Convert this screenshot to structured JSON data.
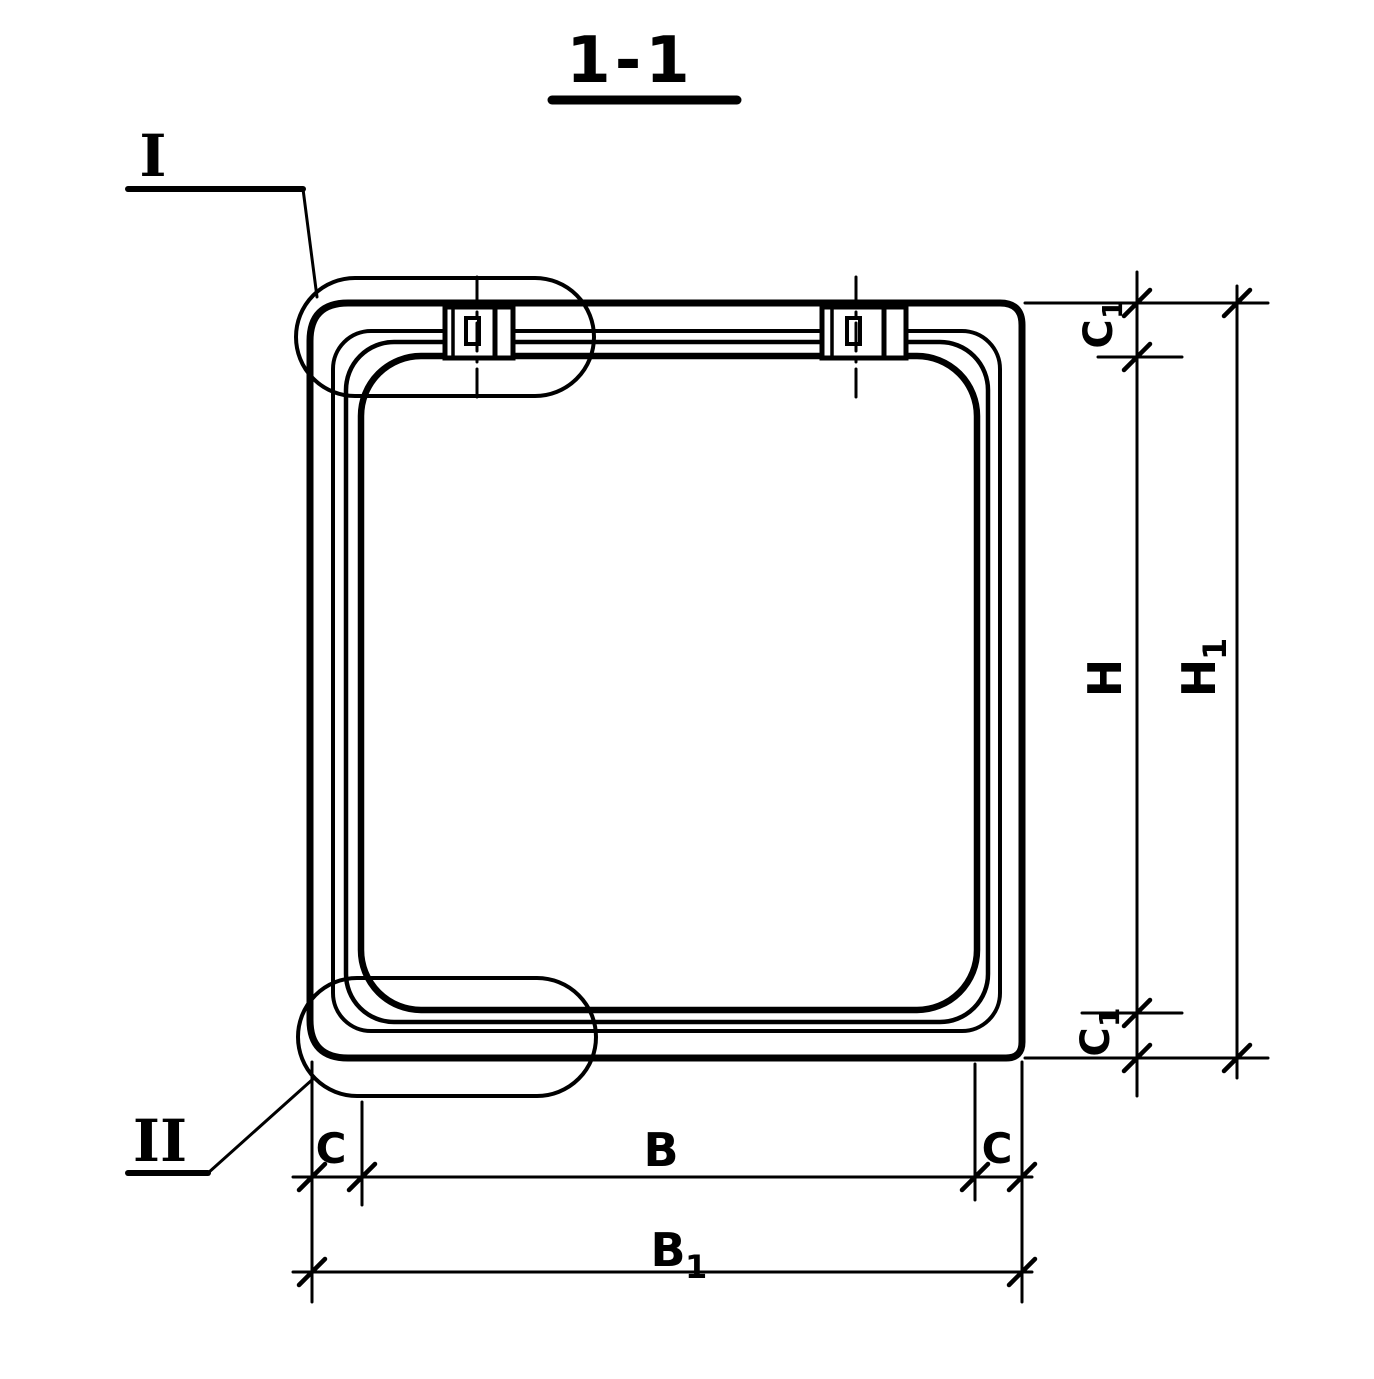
{
  "colors": {
    "ink": "#000000",
    "paper": "#ffffff"
  },
  "title": "1-1",
  "callouts": {
    "detail_one": "I",
    "detail_two": "II"
  },
  "dim_labels": {
    "c1_top": {
      "main": "C",
      "sub": "1"
    },
    "h": {
      "main": "H"
    },
    "h1": {
      "main": "H",
      "sub": "1"
    },
    "c1_bottom": {
      "main": "C",
      "sub": "1"
    },
    "c_left": {
      "main": "C"
    },
    "b": {
      "main": "B"
    },
    "c_right": {
      "main": "C"
    },
    "b1": {
      "main": "B",
      "sub": "1"
    }
  }
}
